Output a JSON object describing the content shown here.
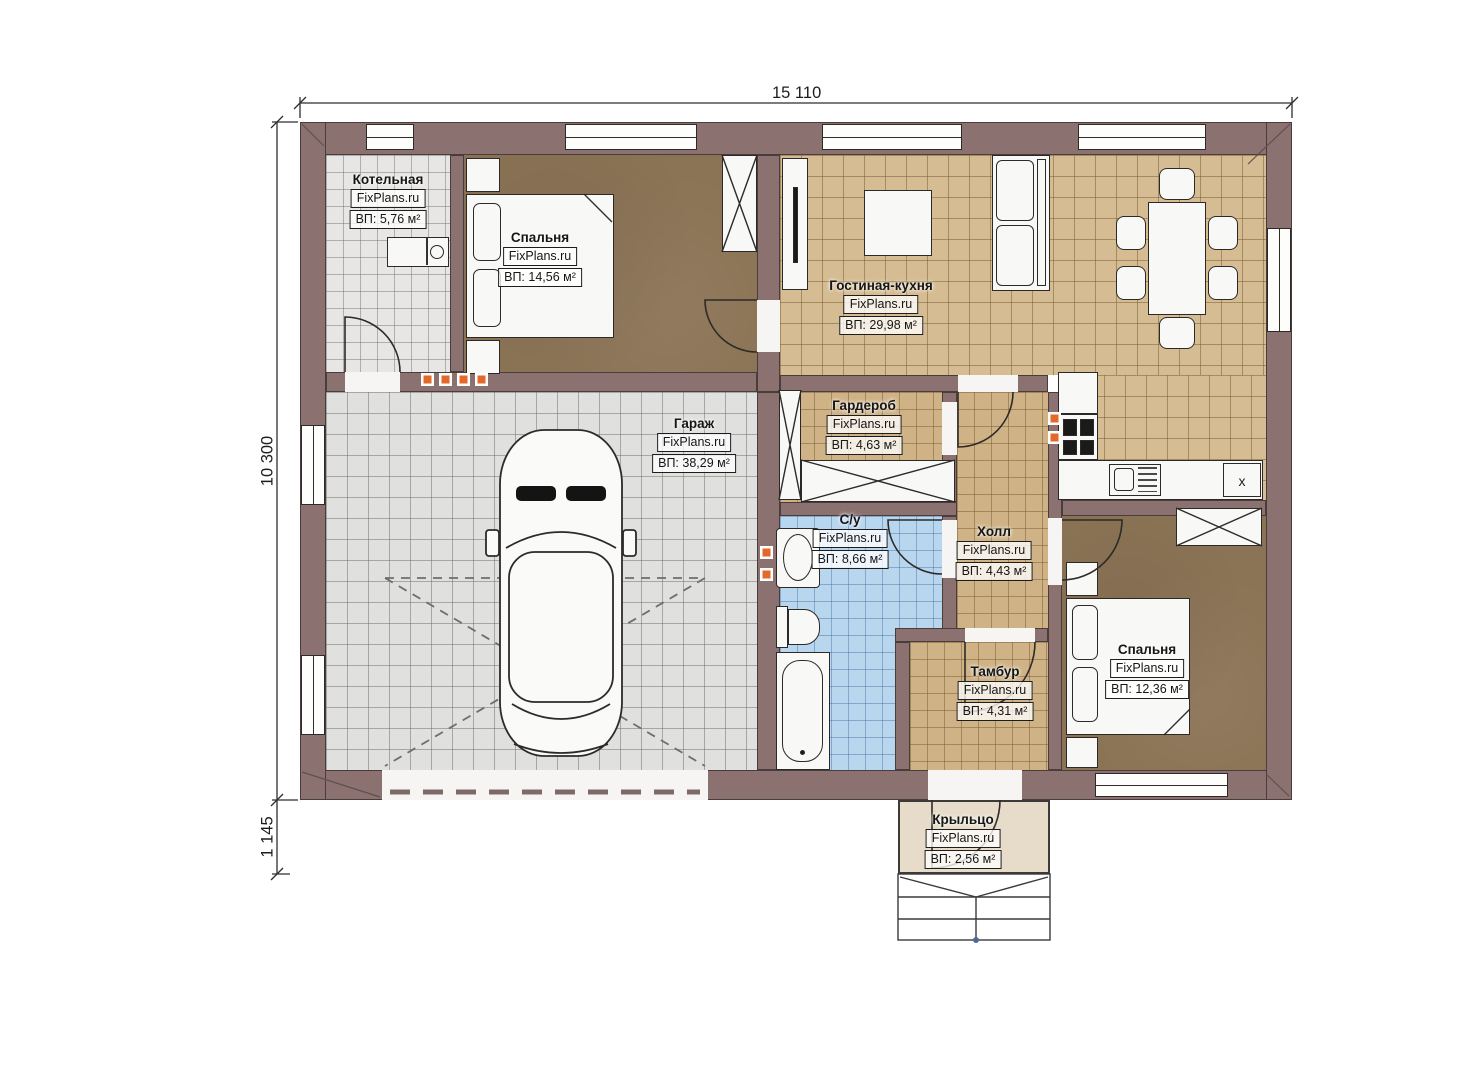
{
  "brand": "FixPlans.ru",
  "dimensions": {
    "width_top": "15 110",
    "height_left": "10 300",
    "porch_left": "1 145"
  },
  "rooms": [
    {
      "id": "boiler",
      "name": "Котельная",
      "area": "ВП: 5,76 м²"
    },
    {
      "id": "bedroom1",
      "name": "Спальня",
      "area": "ВП: 14,56 м²"
    },
    {
      "id": "living",
      "name": "Гостиная-кухня",
      "area": "ВП: 29,98 м²"
    },
    {
      "id": "garage",
      "name": "Гараж",
      "area": "ВП: 38,29 м²"
    },
    {
      "id": "wardrobe",
      "name": "Гардероб",
      "area": "ВП: 4,63 м²"
    },
    {
      "id": "bathroom",
      "name": "С/у",
      "area": "ВП: 8,66 м²"
    },
    {
      "id": "hall",
      "name": "Холл",
      "area": "ВП: 4,43 м²"
    },
    {
      "id": "tambour",
      "name": "Тамбур",
      "area": "ВП: 4,31 м²"
    },
    {
      "id": "bedroom2",
      "name": "Спальня",
      "area": "ВП: 12,36 м²"
    },
    {
      "id": "porch",
      "name": "Крыльцо",
      "area": "ВП: 2,56 м²"
    }
  ],
  "symbols": {
    "kitchen_cabinet_mark": "x"
  },
  "colors": {
    "wall": "#8b7170",
    "living_floor": "#d6bc92",
    "hall_floor": "#cfb386",
    "bath_floor": "#b9d6ef",
    "bedroom_floor": "#8b7355",
    "garage_floor": "#e0e0de",
    "boiler_floor": "#e7e6e4",
    "porch_floor": "#e6dcc9",
    "accent_orange": "#e2692a"
  }
}
